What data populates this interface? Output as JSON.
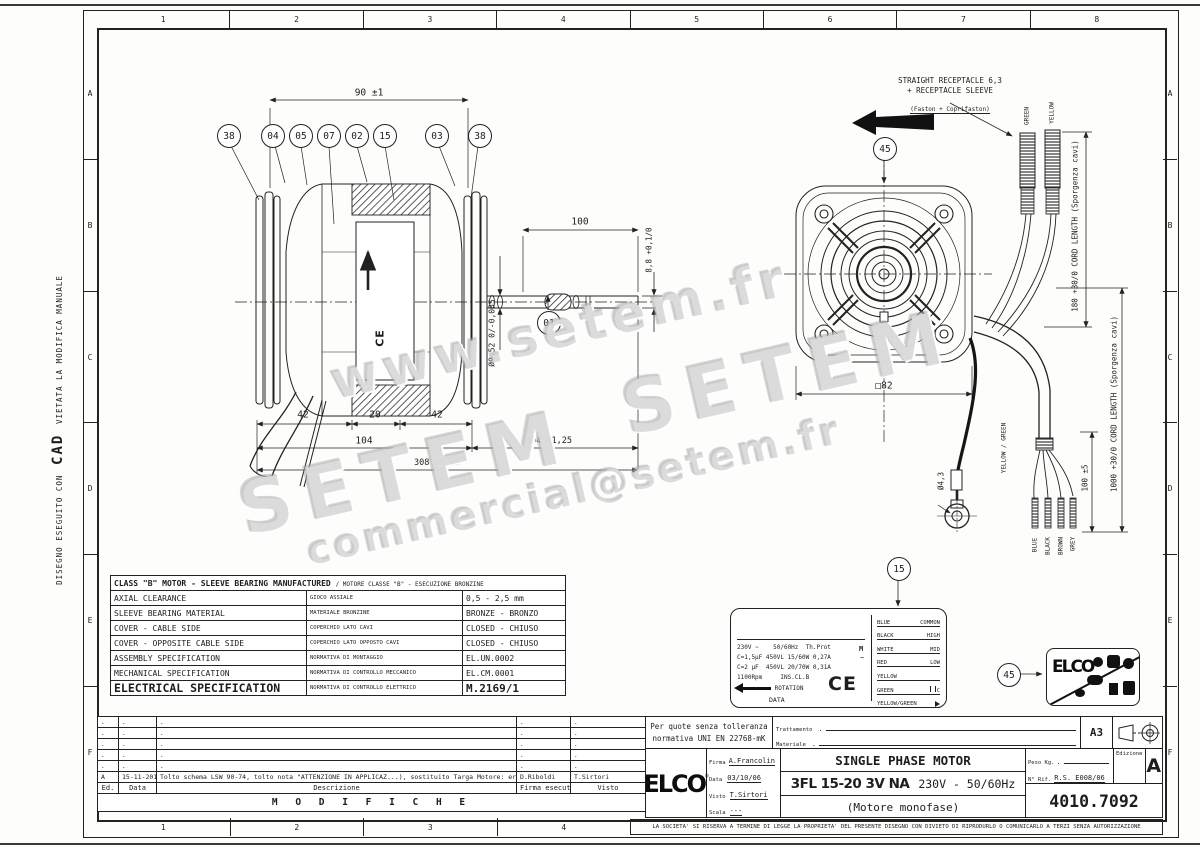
{
  "frame": {
    "cols": [
      "1",
      "2",
      "3",
      "4",
      "5",
      "6",
      "7",
      "8"
    ],
    "rows": [
      "A",
      "B",
      "C",
      "D",
      "E",
      "F"
    ]
  },
  "margin_note": {
    "l1": "DISEGNO ESEGUITO CON",
    "l2": "CAD",
    "l3": "VIETATA LA MODIFICA MANUALE"
  },
  "watermark": {
    "w1": "www.setem.fr",
    "w2": "SETEM",
    "w3": "SETEM",
    "w4": "commercial@setem.fr"
  },
  "ce": "CE",
  "balloons": {
    "b1": "38",
    "b2": "04",
    "b3": "05",
    "b4": "07",
    "b5": "02",
    "b6": "15",
    "b7": "03",
    "b8": "38",
    "shaft": "01",
    "front": "45",
    "plate": "15",
    "weee": "45"
  },
  "dims": {
    "d90": "90 ±1",
    "d100": "100",
    "d88": "8,8 +0,1/0",
    "d952": "Ø9,52 0/-0,035",
    "d42a": "42",
    "d20": "20",
    "d42b": "42",
    "d104": "104",
    "d204": "204 ±1,25",
    "d308": "308 ±1,25",
    "d82": "□82",
    "d43": "Ø4,3",
    "d100b": "100 ±5",
    "cord180": "180 +30/0 CORD LENGTH (Sporgenza cavi)",
    "cord1000": "1000 +30/0 CORD LENGTH (Sporgenza cavi)"
  },
  "receptacle_note": {
    "l1": "STRAIGHT RECEPTACLE 6,3",
    "l2": "+ RECEPTACLE SLEEVE",
    "l3": "(Faston + Coprifaston)"
  },
  "wire_labels": {
    "green": "GREEN",
    "yellow": "YELLOW",
    "blue": "BLUE",
    "black": "BLACK",
    "brown": "BROWN",
    "grey": "GREY",
    "earth": "YELLOW / GREEN"
  },
  "spec_table": {
    "title_en": "CLASS \"B\" MOTOR - SLEEVE BEARING MANUFACTURED",
    "title_it": "/ MOTORE CLASSE \"B\" - ESECUZIONE BRONZINE",
    "rows": [
      {
        "en": "AXIAL CLEARANCE",
        "it": "GIOCO ASSIALE",
        "val": "0,5 - 2,5 mm"
      },
      {
        "en": "SLEEVE BEARING MATERIAL",
        "it": "MATERIALE BRONZINE",
        "val": "BRONZE - BRONZO"
      },
      {
        "en": "COVER - CABLE SIDE",
        "it": "COPERCHIO LATO CAVI",
        "val": "CLOSED - CHIUSO"
      },
      {
        "en": "COVER - OPPOSITE CABLE SIDE",
        "it": "COPERCHIO LATO OPPOSTO CAVI",
        "val": "CLOSED - CHIUSO"
      },
      {
        "en": "ASSEMBLY SPECIFICATION",
        "it": "NORMATIVA DI MONTAGGIO",
        "val": "EL.UN.0002"
      },
      {
        "en": "MECHANICAL SPECIFICATION",
        "it": "NORMATIVA DI CONTROLLO MECCANICO",
        "val": "EL.CM.0001"
      },
      {
        "en": "ELECTRICAL SPECIFICATION",
        "it": "NORMATIVA DI CONTROLLO ELETTRICO",
        "val": "M.2169/1"
      }
    ]
  },
  "nameplate": {
    "line1": "230V ~    50/60Hz  Th.Prot",
    "line2": "C=1,5µF 450VL 15/60W 0,27A",
    "line3": "C=2 µF  450VL 20/70W 0,31A",
    "line4": "1100Rpm     INS.CL.B",
    "rotation": "ROTATION",
    "data": "DATA",
    "m": "M",
    "tilde": "~",
    "wires": [
      {
        "c": "BLUE",
        "t": "COMMON"
      },
      {
        "c": "BLACK",
        "t": "HIGH"
      },
      {
        "c": "WHITE",
        "t": "MID"
      },
      {
        "c": "RED",
        "t": "LOW"
      },
      {
        "c": "YELLOW",
        "t": ""
      },
      {
        "c": "GREEN",
        "t": "C"
      },
      {
        "c": "YELLOW/GREEN",
        "t": ""
      }
    ]
  },
  "weee": {
    "logo": "ELCO"
  },
  "title_block": {
    "tolerance_l1": "Per quote senza tolleranza",
    "tolerance_l2": "normativa UNI EN 22768-mK",
    "trattamento_label": "Trattamento",
    "trattamento_value": ".",
    "materiale_label": "Materiale",
    "materiale_value": ".",
    "format": "A3",
    "logo": "ELCO",
    "logo_r": "®",
    "firma_label": "Firma",
    "firma": "A.Francolin",
    "data_label": "Data",
    "data": "03/10/06",
    "visto_label": "Visto",
    "visto": "T.Sirtori",
    "scala_label": "Scala",
    "scala": "---",
    "title1": "SINGLE PHASE MOTOR",
    "title2a": "3FL 15-20 3V NA",
    "title2b": "230V - 50/60Hz",
    "title3": "(Motore monofase)",
    "peso_label": "Peso Kg.",
    "peso_value": ".",
    "rif_label": "N° Rif.",
    "rif_value": "R.S. E008/06",
    "edizione_label": "Edizione",
    "edizione": "A",
    "code": "4010.7092"
  },
  "revision": {
    "placeholder": ".",
    "row_a": {
      "ed": "A",
      "data": "15-11-2010",
      "desc": "Tolto schema LSW 90-74, tolto nota \"ATTENZIONE  IN APPLICAZ...), sostituito Targa Motore: era 11 x 50.",
      "firma": "D.Riboldi",
      "visto": "T.Sirtori"
    },
    "headers": {
      "ed": "Ed.",
      "data": "Data",
      "desc": "Descrizione",
      "firma": "Firma esecutore",
      "visto": "Visto"
    },
    "modifiche": "M O D I F I C H E"
  },
  "disclaimer": "LA SOCIETA' SI RISERVA A TERMINE DI LEGGE LA PROPRIETA' DEL PRESENTE DISEGNO CON DIVIETO DI RIPRODURLO O COMUNICARLO A TERZI SENZA AUTORIZZAZIONE"
}
